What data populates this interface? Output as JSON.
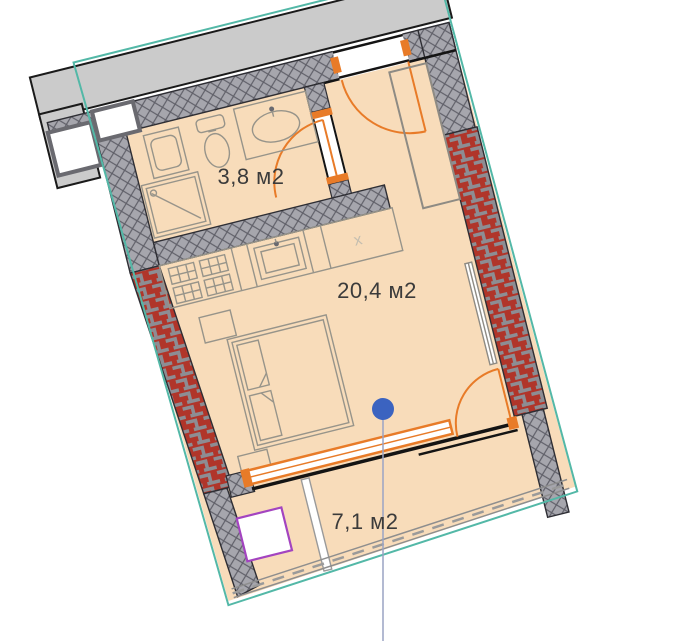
{
  "floor_plan": {
    "title": "Studio apartment floor plan",
    "rooms": [
      {
        "id": "bathroom",
        "area_label": "3,8 м2"
      },
      {
        "id": "living-room",
        "area_label": "20,4 м2"
      },
      {
        "id": "balcony",
        "area_label": "7,1 м2"
      }
    ],
    "kitchen": {
      "appliance_marker": "х"
    },
    "colors": {
      "floor": "#f8dcba",
      "boundary_teal": "#53b8a7",
      "exterior_wall_red": "#b0352a",
      "interior_wall_gray": "#a6a6ad",
      "door_orange": "#e87b28",
      "marker_blue": "#3b63c0",
      "equipment_purple": "#a344c0",
      "corridor_gray": "#cbcbcb"
    },
    "fixtures": [
      "washing-machine",
      "shower",
      "toilet",
      "sink",
      "kitchen-stove",
      "kitchen-sink",
      "wardrobe",
      "bed",
      "radiator"
    ]
  }
}
